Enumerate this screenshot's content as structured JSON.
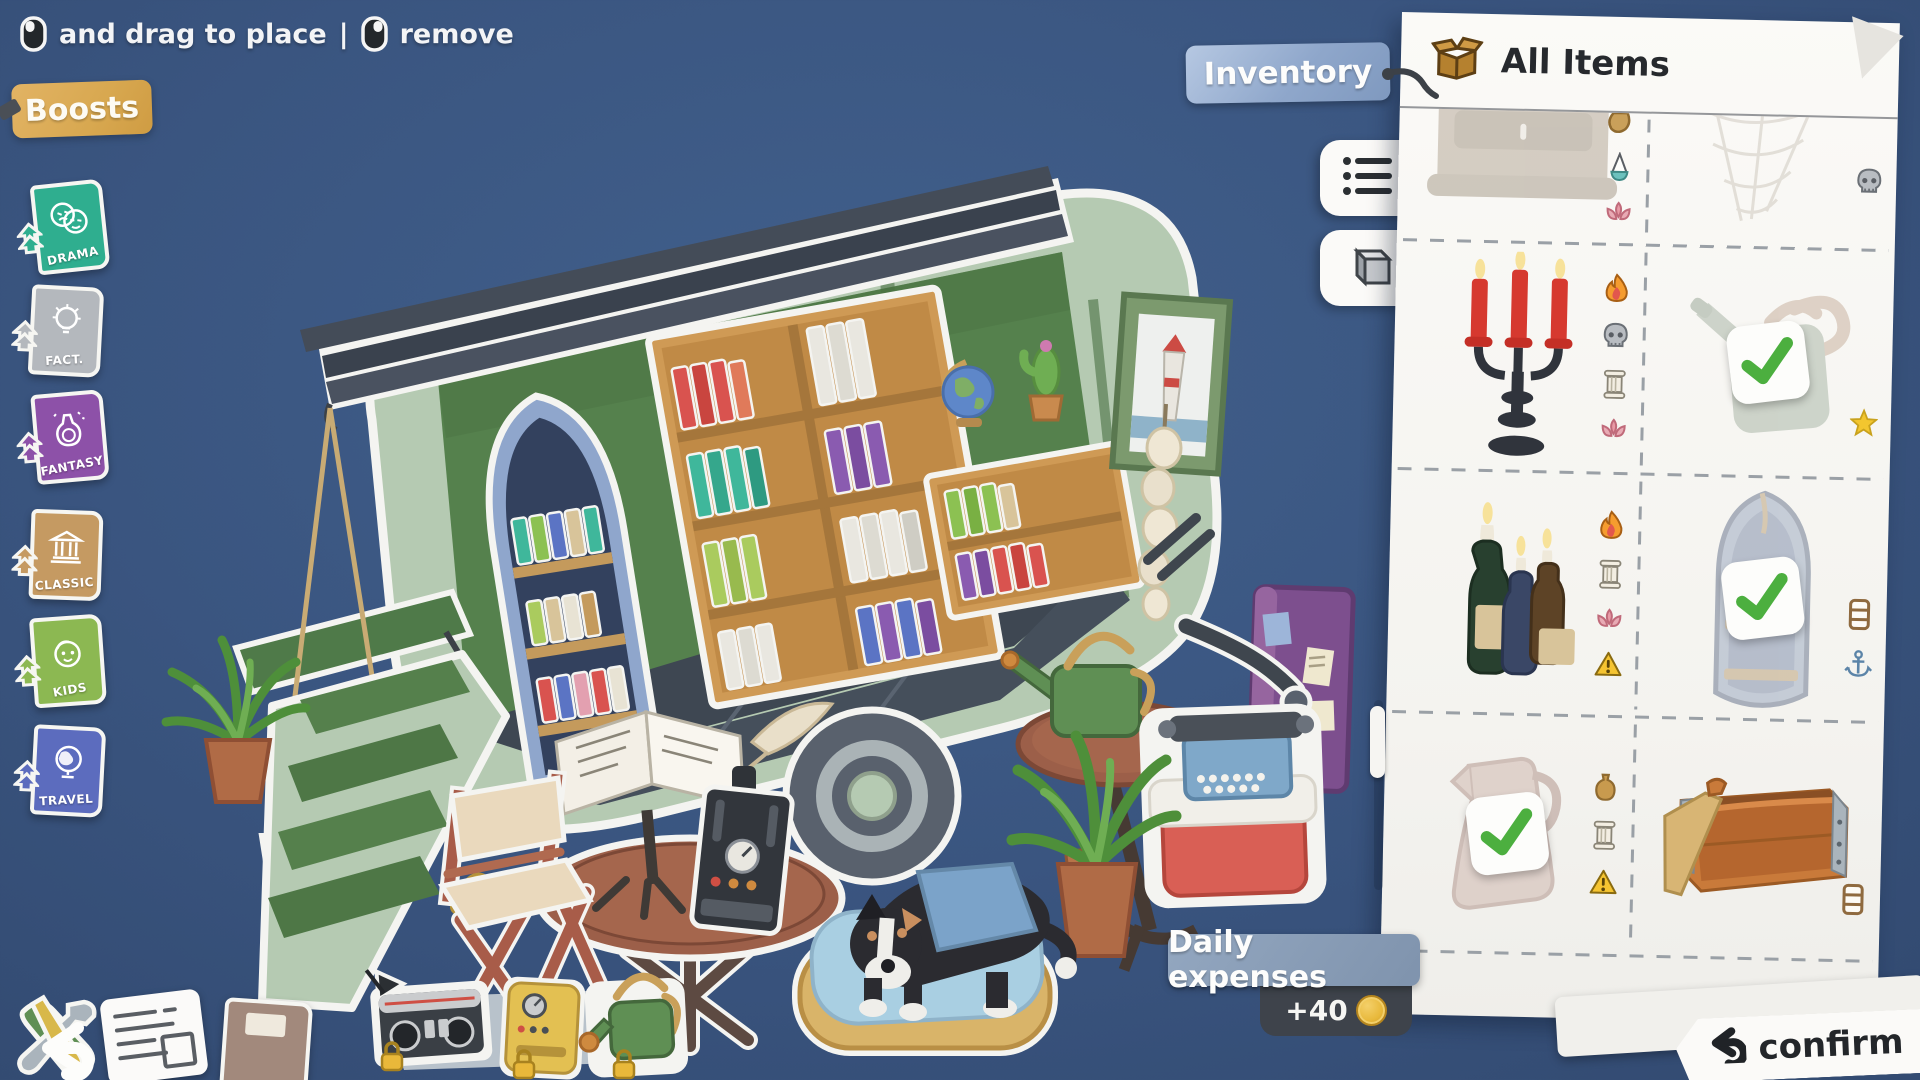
{
  "hint": {
    "left_mouse_icon": "left-mouse-button-icon",
    "left_action": "and drag to place",
    "separator": "|",
    "right_mouse_icon": "right-mouse-button-icon",
    "right_action": "remove"
  },
  "boosts": {
    "label": "Boosts",
    "books": [
      {
        "label": "DRAMA",
        "color": "#2fae8f",
        "doodle": "drama-masks-icon"
      },
      {
        "label": "FACT.",
        "color": "#b4b8bd",
        "doodle": "lightbulb-icon"
      },
      {
        "label": "FANTASY",
        "color": "#8d51a8",
        "doodle": "potion-icon"
      },
      {
        "label": "CLASSIC",
        "color": "#c59a62",
        "doodle": "temple-icon"
      },
      {
        "label": "KIDS",
        "color": "#8cb852",
        "doodle": "child-face-icon"
      },
      {
        "label": "TRAVEL",
        "color": "#5c6cbe",
        "doodle": "globe-icon"
      }
    ]
  },
  "inventory": {
    "tag_label": "Inventory",
    "title": "All Items",
    "header_icon": "cardboard-box-icon",
    "tabs": [
      {
        "icon": "list-view-icon"
      },
      {
        "icon": "cube-view-icon"
      }
    ],
    "rows": [
      {
        "cells": [
          {
            "item": "storage-chest",
            "faded": true,
            "checked": false,
            "badges": [
              "bag-icon",
              "oil-lamp-icon",
              "lotus-icon"
            ]
          },
          {
            "item": "spider-web",
            "faded": true,
            "checked": false,
            "badges": [
              "skull-icon"
            ]
          }
        ]
      },
      {
        "cells": [
          {
            "item": "candelabra",
            "faded": false,
            "checked": false,
            "badges": [
              "flame-icon",
              "skull-icon",
              "column-icon",
              "lotus-icon"
            ]
          },
          {
            "item": "watering-can",
            "faded": true,
            "checked": true,
            "badges": [
              "star-icon"
            ]
          }
        ]
      },
      {
        "cells": [
          {
            "item": "bottle-candles",
            "faded": false,
            "checked": false,
            "badges": [
              "flame-icon",
              "column-icon",
              "lotus-icon",
              "warning-icon"
            ]
          },
          {
            "item": "boat-bookshelf",
            "faded": true,
            "checked": true,
            "badges": [
              "shelf-icon",
              "anchor-icon"
            ]
          }
        ]
      },
      {
        "cells": [
          {
            "item": "pitcher",
            "faded": true,
            "checked": true,
            "badges": [
              "vase-icon",
              "column-icon",
              "warning-icon"
            ]
          },
          {
            "item": "wooden-crate",
            "faded": false,
            "checked": false,
            "badges": [
              "shelf-icon"
            ]
          }
        ]
      }
    ]
  },
  "expenses": {
    "label": "Daily expenses",
    "amount": "+40",
    "coin_icon": "coin-icon"
  },
  "confirm": {
    "label": "confirm",
    "icon": "undo-arrow-icon"
  },
  "toolbar": {
    "tools_sticker": "tools-back-button",
    "notes": [
      {
        "badge": "1",
        "icon": "newspaper-sticker"
      },
      {
        "badge": "2",
        "icon": "journal-sticker"
      }
    ]
  },
  "locked_tray": {
    "lock_icon": "padlock-icon",
    "items": [
      {
        "icon": "radio-sticker"
      },
      {
        "icon": "coffee-machine-sticker"
      },
      {
        "icon": "watering-can-sticker"
      }
    ]
  },
  "scene": {
    "objects": [
      "caravan-bookshop",
      "slate-roof",
      "boat-bookshelf",
      "wall-bookshelf",
      "low-bookshelf",
      "globe",
      "cactus",
      "lighthouse-picture",
      "purple-cabinet",
      "watering-can",
      "round-side-table",
      "terracotta-shaker",
      "hanging-flower-basket",
      "green-awning",
      "garlic-string",
      "wheel",
      "trailer-hitch",
      "ramp-steps",
      "fern-pot-left",
      "fern-pot-right",
      "directors-chair",
      "round-table",
      "open-book-stand",
      "quill-and-ink",
      "black-radio-device",
      "yellow-bell",
      "dog-on-cushion-bed",
      "typewriter-on-red-box"
    ]
  },
  "colors": {
    "background": "#3a5580",
    "panel": "#f8f7f4",
    "accent_tan": "#d8a850",
    "accent_blue": "#8fa7cb",
    "expense_dark": "#3e434b",
    "coin_gold": "#e8b83a",
    "check_green": "#4caf3f",
    "caravan_sage": "#b5cab2",
    "interior_green": "#55814d",
    "wood": "#cf9a55"
  }
}
